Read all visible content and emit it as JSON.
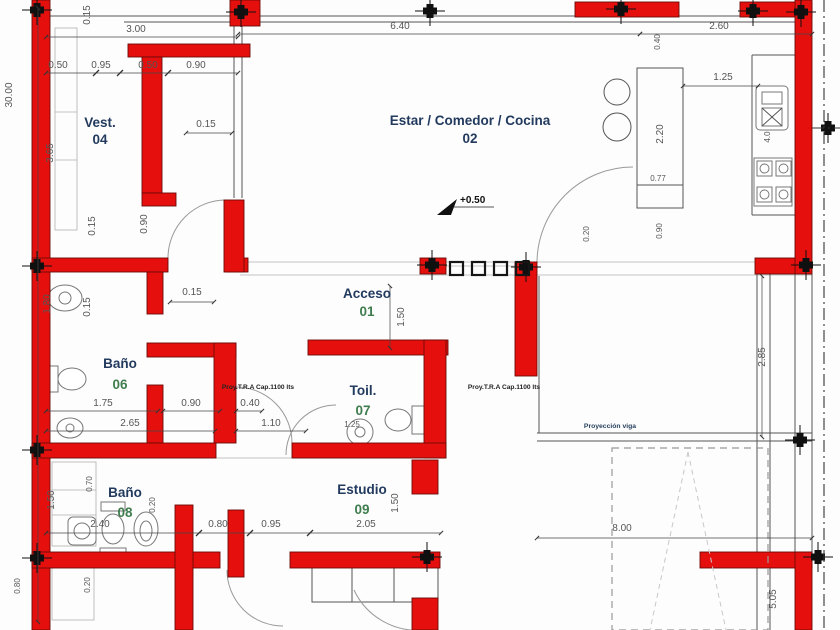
{
  "drawing": {
    "title": "Planta arquitectónica",
    "rooms": {
      "vest": {
        "label": "Vest.",
        "num": "04"
      },
      "estar": {
        "label": "Estar / Comedor / Cocina",
        "num": "02"
      },
      "acceso": {
        "label": "Acceso",
        "num": "01"
      },
      "bano6": {
        "label": "Baño",
        "num": "06"
      },
      "toil": {
        "label": "Toil.",
        "num": "07"
      },
      "bano8": {
        "label": "Baño",
        "num": "08"
      },
      "estudio": {
        "label": "Estudio",
        "num": "09"
      }
    },
    "annotations": {
      "level": "+0.50",
      "tank": "Proy.T.R.A Cap.1100 lts",
      "beam": "Proyección viga"
    },
    "dims": {
      "d30_00": "30.00",
      "d8_00": "8.00",
      "d6_40": "6.40",
      "d5_05": "5.05",
      "d4_0": "4.0",
      "d3_65": "3.65",
      "d3_00": "3.00",
      "d2_85": "2.85",
      "d2_65": "2.65",
      "d2_60": "2.60",
      "d2_40": "2.40",
      "d2_20": "2.20",
      "d2_05": "2.05",
      "d1_80": "1.80",
      "d1_75": "1.75",
      "d1_50": "1.50",
      "d1_25": "1.25",
      "d1_10": "1.10",
      "d0_95": "0.95",
      "d0_90": "0.90",
      "d0_80": "0.80",
      "d0_77": "0.77",
      "d0_70": "0.70",
      "d0_50": "0.50",
      "d0_40": "0.40",
      "d0_20": "0.20",
      "d0_15": "0.15"
    },
    "colors": {
      "wall": "#e5100e",
      "dim": "#565656",
      "room": "#223a5e",
      "green": "#3f7d4e"
    }
  }
}
